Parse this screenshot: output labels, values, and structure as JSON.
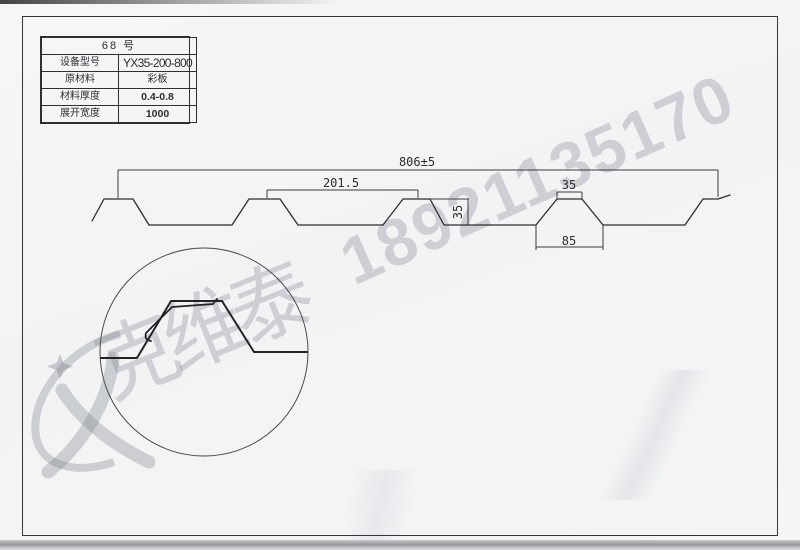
{
  "page": {
    "background_color": "#f3f4f6",
    "line_color": "#2c2d31",
    "watermark_color": "#aeb1ba"
  },
  "spec_table": {
    "title": "68  号",
    "rows": [
      {
        "label": "设备型号",
        "value": "YX35-200-800"
      },
      {
        "label": "原材料",
        "value": "彩板"
      },
      {
        "label": "材料厚度",
        "value": "0.4-0.8"
      },
      {
        "label": "展开宽度",
        "value": "1000"
      }
    ]
  },
  "dimensions": {
    "overall_width": "806±5",
    "pitch": "201.5",
    "rib_height": "35",
    "rib_top_width": "35",
    "rib_bottom_width": "85"
  },
  "watermark": {
    "phone": "18921135170",
    "company": "克维泰",
    "logo": "flame-star-logo"
  }
}
